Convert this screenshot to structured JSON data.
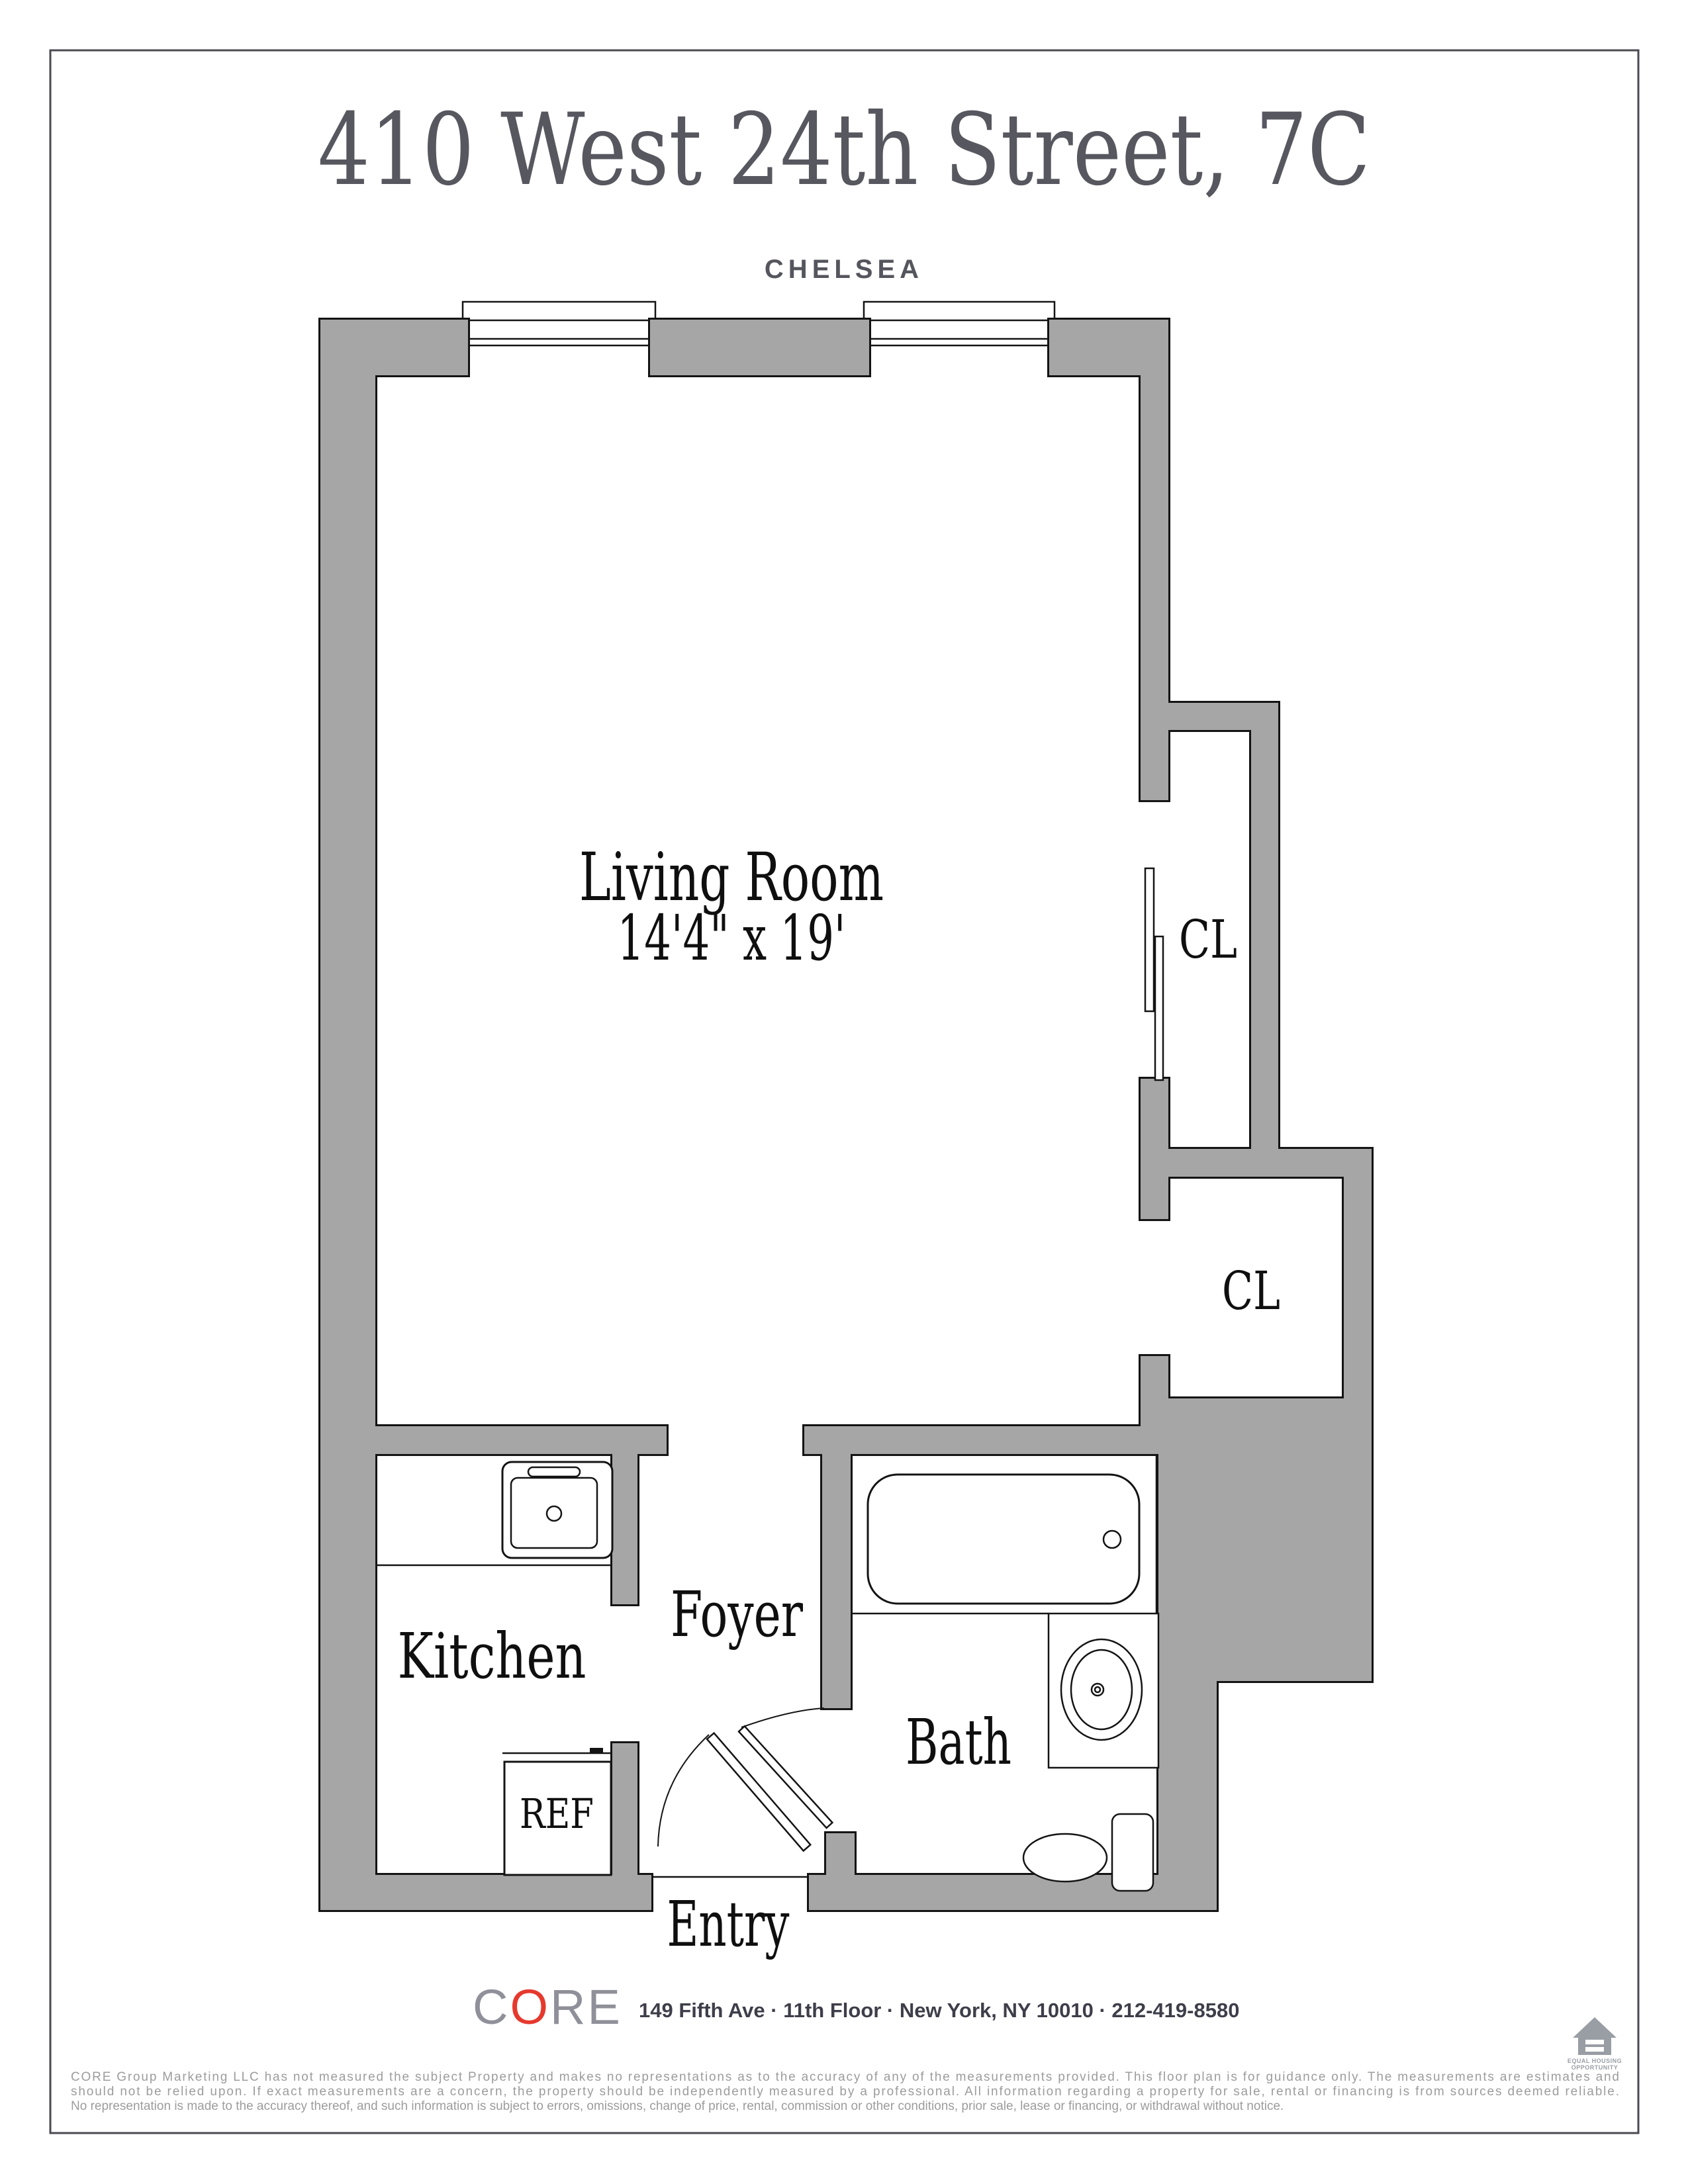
{
  "header": {
    "title": "410 West 24th Street, 7C",
    "neighborhood": "CHELSEA"
  },
  "plan": {
    "living_room": {
      "label": "Living Room",
      "dimensions": "14'4\" x 19'"
    },
    "closet_upper_label": "CL",
    "closet_lower_label": "CL",
    "kitchen_label": "Kitchen",
    "foyer_label": "Foyer",
    "bath_label": "Bath",
    "refrigerator_label": "REF",
    "entry_label": "Entry"
  },
  "footer": {
    "brand": {
      "c": "C",
      "o": "O",
      "re": "RE"
    },
    "address": "149 Fifth Ave · 11th Floor · New York, NY 10010 · 212-419-8580",
    "equal_housing": {
      "line1": "EQUAL HOUSING",
      "line2": "OPPORTUNITY"
    },
    "disclaimer_lines": [
      "CORE Group Marketing LLC has not measured the subject Property and makes no representations as to the accuracy of any of the measurements provided. This floor plan is for guidance only. The measurements are estimates and",
      "should not be relied upon. If exact measurements are a concern, the property should be independently measured by a professional. All information regarding a property for sale, rental or financing is from sources deemed reliable.",
      "No representation is made to the accuracy thereof, and such information is subject to errors, omissions, change of price, rental, commission or other conditions, prior sale, lease or financing, or withdrawal without notice."
    ]
  },
  "colors": {
    "wall_fill": "#a6a6a6",
    "wall_outline": "#141414",
    "brand_red": "#e6392e",
    "title_gray": "#57575f",
    "disclaimer_gray": "#9c9c9c"
  }
}
